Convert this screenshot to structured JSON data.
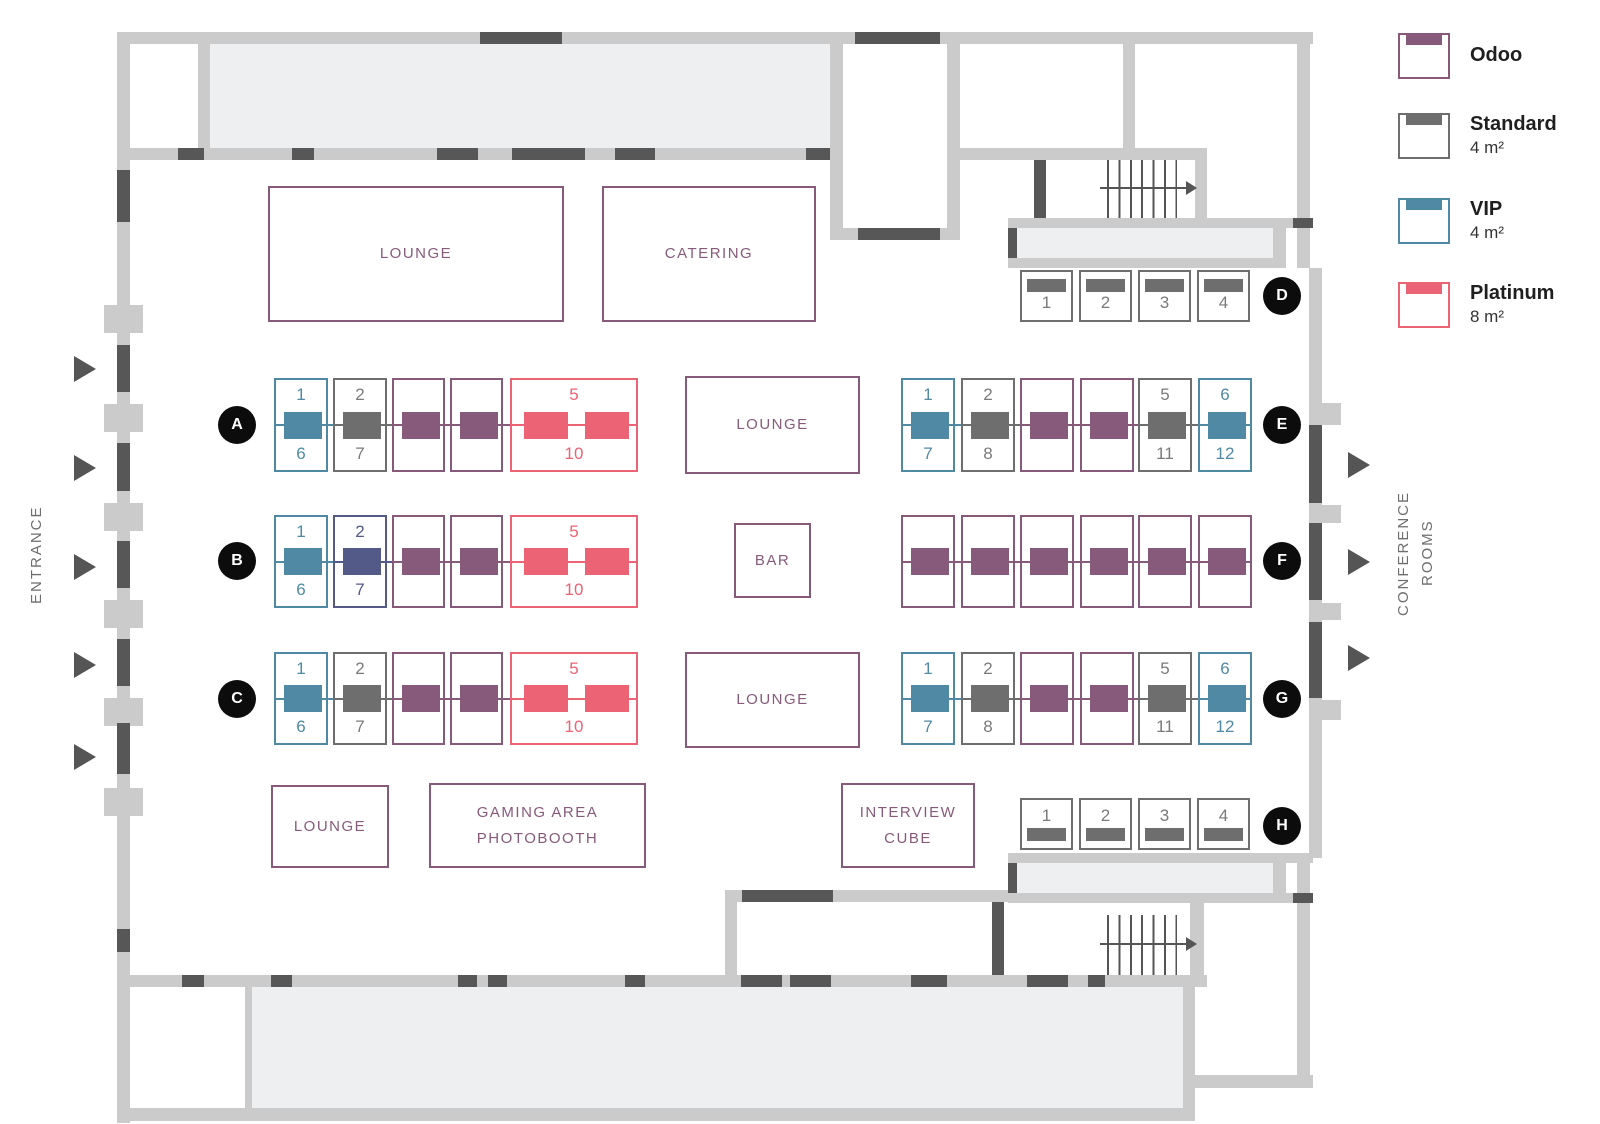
{
  "colors": {
    "odoo": "#875a7b",
    "standard": "#6e6e6e",
    "vip": "#5089a3",
    "platinum": "#eb6374",
    "dark": "#535a87",
    "standard_number": "#7a7a7a",
    "wall": "#cbcbcb",
    "door": "#575757",
    "room_fill": "#edeff0",
    "badge_bg": "#0c0c0c",
    "badge_text": "#ffffff",
    "area_text": "#875a7b",
    "side_text": "#6e6e6e",
    "legend_label": "#1f1f1f",
    "legend_size": "#333333"
  },
  "legend": {
    "items": [
      {
        "type": "odoo",
        "label": "Odoo",
        "size": "",
        "y": 33
      },
      {
        "type": "standard",
        "label": "Standard",
        "size": "4 m²",
        "y": 113
      },
      {
        "type": "vip",
        "label": "VIP",
        "size": "4 m²",
        "y": 198
      },
      {
        "type": "platinum",
        "label": "Platinum",
        "size": "8 m²",
        "y": 282
      }
    ]
  },
  "side_labels": {
    "entrance": "ENTRANCE",
    "conference_line1": "CONFERENCE",
    "conference_line2": "ROOMS"
  },
  "areas": [
    {
      "id": "lounge-top",
      "lines": [
        "LOUNGE"
      ],
      "x": 268,
      "y": 186,
      "w": 296,
      "h": 136
    },
    {
      "id": "catering",
      "lines": [
        "CATERING"
      ],
      "x": 602,
      "y": 186,
      "w": 214,
      "h": 136
    },
    {
      "id": "lounge-mid-top",
      "lines": [
        "LOUNGE"
      ],
      "x": 685,
      "y": 376,
      "w": 175,
      "h": 98
    },
    {
      "id": "bar",
      "lines": [
        "BAR"
      ],
      "x": 734,
      "y": 523,
      "w": 77,
      "h": 75
    },
    {
      "id": "lounge-mid-bottom",
      "lines": [
        "LOUNGE"
      ],
      "x": 685,
      "y": 652,
      "w": 175,
      "h": 96
    },
    {
      "id": "lounge-bottom",
      "lines": [
        "LOUNGE"
      ],
      "x": 271,
      "y": 785,
      "w": 118,
      "h": 83
    },
    {
      "id": "gaming-area",
      "lines": [
        "GAMING AREA",
        "PHOTOBOOTH"
      ],
      "x": 429,
      "y": 783,
      "w": 217,
      "h": 85
    },
    {
      "id": "interview-cube",
      "lines": [
        "INTERVIEW",
        "CUBE"
      ],
      "x": 841,
      "y": 783,
      "w": 134,
      "h": 85
    }
  ],
  "rows": [
    {
      "id": "A",
      "badge": "A",
      "badge_x": 237,
      "badge_y": 425,
      "y": 378,
      "h": 94,
      "orient": "middle",
      "booths": [
        {
          "type": "vip",
          "x": 274,
          "w": 54,
          "top": "1",
          "bottom": "6"
        },
        {
          "type": "standard",
          "x": 333,
          "w": 54,
          "top": "2",
          "bottom": "7"
        },
        {
          "type": "odoo",
          "x": 392,
          "w": 53
        },
        {
          "type": "odoo",
          "x": 450,
          "w": 53
        },
        {
          "type": "platinum",
          "x": 510,
          "w": 128,
          "top": "5",
          "bottom": "10",
          "bars": 2
        }
      ]
    },
    {
      "id": "B",
      "badge": "B",
      "badge_x": 237,
      "badge_y": 561,
      "y": 515,
      "h": 93,
      "orient": "middle",
      "booths": [
        {
          "type": "vip",
          "x": 274,
          "w": 54,
          "top": "1",
          "bottom": "6"
        },
        {
          "type": "dark",
          "x": 333,
          "w": 54,
          "top": "2",
          "bottom": "7"
        },
        {
          "type": "odoo",
          "x": 392,
          "w": 53
        },
        {
          "type": "odoo",
          "x": 450,
          "w": 53
        },
        {
          "type": "platinum",
          "x": 510,
          "w": 128,
          "top": "5",
          "bottom": "10",
          "bars": 2
        }
      ]
    },
    {
      "id": "C",
      "badge": "C",
      "badge_y": 699,
      "badge_x": 237,
      "y": 652,
      "h": 93,
      "orient": "middle",
      "booths": [
        {
          "type": "vip",
          "x": 274,
          "w": 54,
          "top": "1",
          "bottom": "6"
        },
        {
          "type": "standard",
          "x": 333,
          "w": 54,
          "top": "2",
          "bottom": "7"
        },
        {
          "type": "odoo",
          "x": 392,
          "w": 53
        },
        {
          "type": "odoo",
          "x": 450,
          "w": 53
        },
        {
          "type": "platinum",
          "x": 510,
          "w": 128,
          "top": "5",
          "bottom": "10",
          "bars": 2
        }
      ]
    },
    {
      "id": "D",
      "badge": "D",
      "badge_x": 1282,
      "badge_y": 296,
      "y": 270,
      "h": 52,
      "orient": "top",
      "booths": [
        {
          "type": "standard",
          "x": 1020,
          "w": 53,
          "num": "1"
        },
        {
          "type": "standard",
          "x": 1079,
          "w": 53,
          "num": "2"
        },
        {
          "type": "standard",
          "x": 1138,
          "w": 53,
          "num": "3"
        },
        {
          "type": "standard",
          "x": 1197,
          "w": 53,
          "num": "4"
        }
      ]
    },
    {
      "id": "E",
      "badge": "E",
      "badge_x": 1282,
      "badge_y": 425,
      "y": 378,
      "h": 94,
      "orient": "middle",
      "booths": [
        {
          "type": "vip",
          "x": 901,
          "w": 54,
          "top": "1",
          "bottom": "7"
        },
        {
          "type": "standard",
          "x": 961,
          "w": 54,
          "top": "2",
          "bottom": "8"
        },
        {
          "type": "odoo",
          "x": 1020,
          "w": 54
        },
        {
          "type": "odoo",
          "x": 1080,
          "w": 54
        },
        {
          "type": "standard",
          "x": 1138,
          "w": 54,
          "top": "5",
          "bottom": "11"
        },
        {
          "type": "vip",
          "x": 1198,
          "w": 54,
          "top": "6",
          "bottom": "12"
        }
      ]
    },
    {
      "id": "F",
      "badge": "F",
      "badge_x": 1282,
      "badge_y": 561,
      "y": 515,
      "h": 93,
      "orient": "middle",
      "booths": [
        {
          "type": "odoo",
          "x": 901,
          "w": 54
        },
        {
          "type": "odoo",
          "x": 961,
          "w": 54
        },
        {
          "type": "odoo",
          "x": 1020,
          "w": 54
        },
        {
          "type": "odoo",
          "x": 1080,
          "w": 54
        },
        {
          "type": "odoo",
          "x": 1138,
          "w": 54
        },
        {
          "type": "odoo",
          "x": 1198,
          "w": 54
        }
      ]
    },
    {
      "id": "G",
      "badge": "G",
      "badge_x": 1282,
      "badge_y": 699,
      "y": 652,
      "h": 93,
      "orient": "middle",
      "booths": [
        {
          "type": "vip",
          "x": 901,
          "w": 54,
          "top": "1",
          "bottom": "7"
        },
        {
          "type": "standard",
          "x": 961,
          "w": 54,
          "top": "2",
          "bottom": "8"
        },
        {
          "type": "odoo",
          "x": 1020,
          "w": 54
        },
        {
          "type": "odoo",
          "x": 1080,
          "w": 54
        },
        {
          "type": "standard",
          "x": 1138,
          "w": 54,
          "top": "5",
          "bottom": "11"
        },
        {
          "type": "vip",
          "x": 1198,
          "w": 54,
          "top": "6",
          "bottom": "12"
        }
      ]
    },
    {
      "id": "H",
      "badge": "H",
      "badge_x": 1282,
      "badge_y": 826,
      "y": 798,
      "h": 52,
      "orient": "bottom",
      "booths": [
        {
          "type": "standard",
          "x": 1020,
          "w": 53,
          "num": "1"
        },
        {
          "type": "standard",
          "x": 1079,
          "w": 53,
          "num": "2"
        },
        {
          "type": "standard",
          "x": 1138,
          "w": 53,
          "num": "3"
        },
        {
          "type": "standard",
          "x": 1197,
          "w": 53,
          "num": "4"
        }
      ]
    }
  ]
}
